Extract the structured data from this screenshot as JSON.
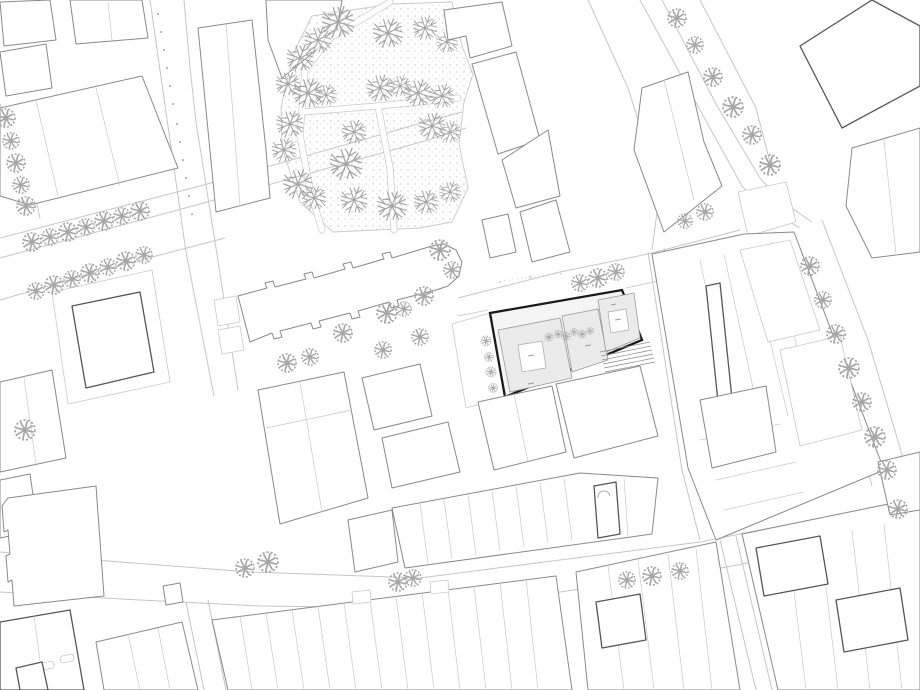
{
  "drawing": {
    "kind": "architectural-site-plan",
    "style": "figure-ground line drawing",
    "title": ""
  },
  "street_label": {
    "marks": "▵··◦·◦·∩◦·◦··◦▵"
  },
  "colors": {
    "paper": "#ffffff",
    "street_line": "#c6c6c6",
    "parcel_line": "#c9c9c9",
    "building_line": "#8a8a8a",
    "building_dark": "#565656",
    "site_outline": "#1a1a1a",
    "site_fill": "#f5f5f5",
    "site_building_fill": "#ebebeb",
    "tree_stroke": "#a6a6a6",
    "park_dot": "#c2c2c2",
    "annotation": "#9a9a9a"
  },
  "icons": {
    "park_tree": "branching-tree-icon",
    "street_tree": "round-canopy-tree-icon"
  }
}
